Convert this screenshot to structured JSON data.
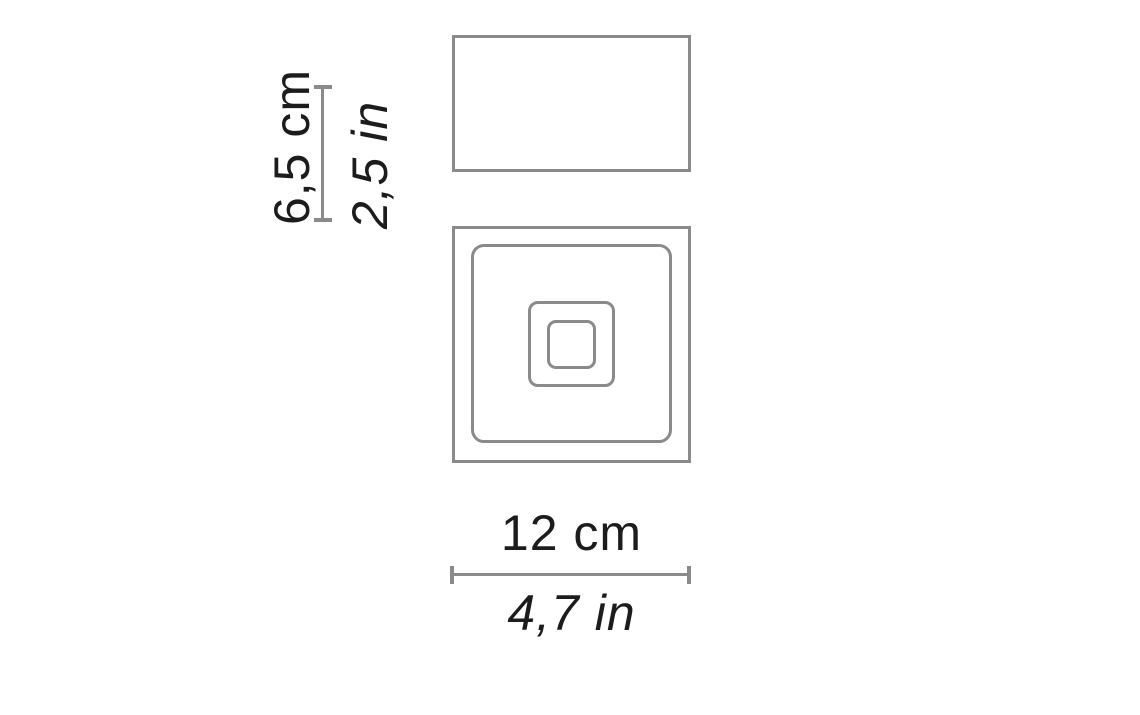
{
  "diagram": {
    "type": "product-dimension-drawing",
    "colors": {
      "background": "#ffffff",
      "stroke": "#8a8a8a",
      "text": "#1c1c1c"
    },
    "height_dimension": {
      "metric": "6,5 cm",
      "imperial": "2,5 in"
    },
    "width_dimension": {
      "metric": "12 cm",
      "imperial": "4,7 in"
    }
  }
}
